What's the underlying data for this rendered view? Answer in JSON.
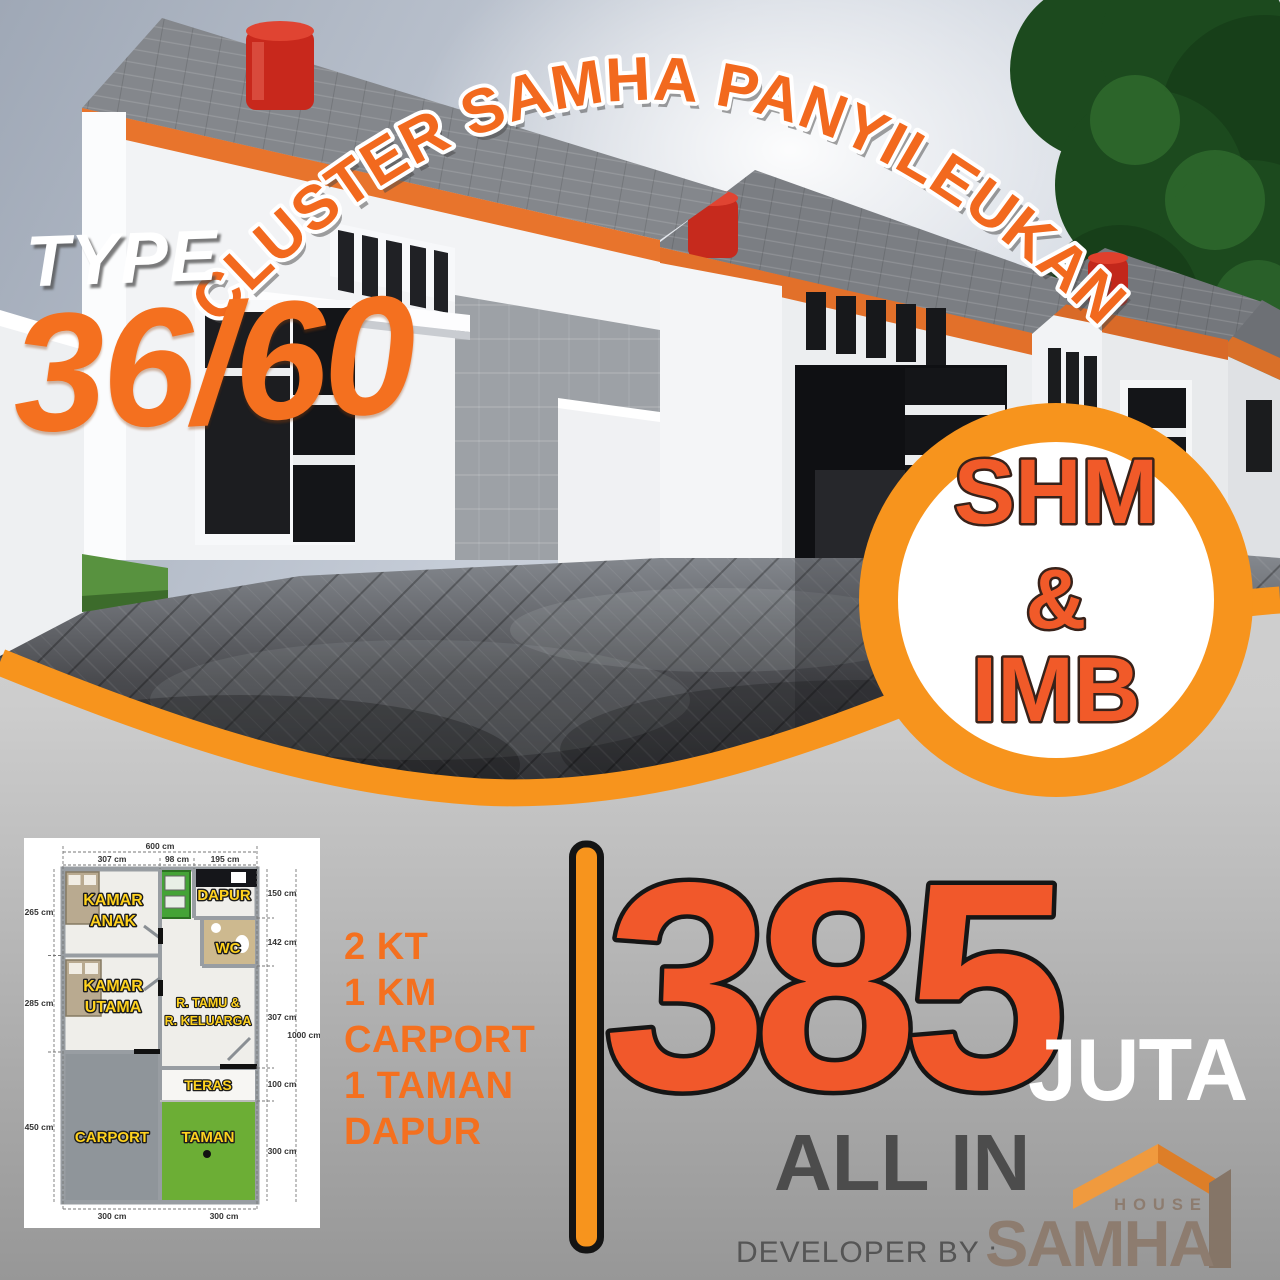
{
  "poster": {
    "title": "CLUSTER SAMHA PANYILEUKAN",
    "type": {
      "label": "TYPE",
      "value": "36/60"
    },
    "badge": {
      "line1": "SHM",
      "line2": "&",
      "line3": "IMB"
    },
    "features": [
      "2 KT",
      "1 KM",
      "CARPORT",
      "1 TAMAN",
      "DAPUR"
    ],
    "price": {
      "amount": "385",
      "unit": "JUTA",
      "note": "ALL IN"
    },
    "developer": {
      "label": "DEVELOPER BY :",
      "brand": "SAMHA",
      "brand_sub": "HOUSE"
    }
  },
  "floor_plan": {
    "rooms": {
      "kamar_anak_l1": "KAMAR",
      "kamar_anak_l2": "ANAK",
      "dapur": "DAPUR",
      "wc": "WC",
      "kamar_utama_l1": "KAMAR",
      "kamar_utama_l2": "UTAMA",
      "r_tamu_l1": "R. TAMU &",
      "r_tamu_l2": "R. KELUARGA",
      "teras": "TERAS",
      "carport": "CARPORT",
      "taman": "TAMAN"
    },
    "dimensions": {
      "top_total": "600 cm",
      "top_left": "307 cm",
      "top_mid": "98 cm",
      "top_right": "195 cm",
      "left_1": "265 cm",
      "left_2": "285 cm",
      "left_3": "450 cm",
      "right_1": "150 cm",
      "right_2": "142 cm",
      "right_3": "307 cm",
      "right_4": "100 cm",
      "right_5": "300 cm",
      "right_total": "1000 cm",
      "bottom_left": "300 cm",
      "bottom_right": "300 cm"
    }
  },
  "colors": {
    "accent_orange": "#F7941D",
    "title_orange": "#F2691E",
    "price_orange": "#F1582B",
    "label_yellow": "#FFD21E",
    "brand_taupe": "#8D7C6F",
    "roof_logo_light": "#F09A3E",
    "roof_logo_dark": "#DD7E28"
  }
}
